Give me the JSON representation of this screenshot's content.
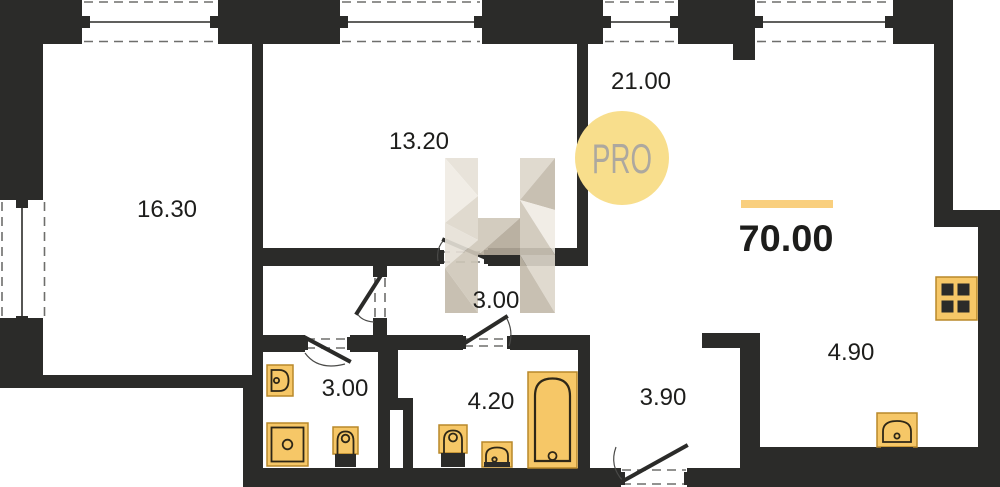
{
  "floorplan": {
    "badge_label": "PRO",
    "total_area": "70.00",
    "rooms": [
      {
        "key": "room-1630",
        "area": "16.30"
      },
      {
        "key": "room-1320",
        "area": "13.20"
      },
      {
        "key": "room-2100",
        "area": "21.00"
      },
      {
        "key": "hallway",
        "area": "3.00"
      },
      {
        "key": "bathroom-small",
        "area": "3.00"
      },
      {
        "key": "bathroom-large",
        "area": "4.20"
      },
      {
        "key": "entry-corridor",
        "area": "3.90"
      },
      {
        "key": "kitchen-niche",
        "area": "4.90"
      }
    ],
    "fixtures": [
      "wall-hung-sink",
      "shower-tray",
      "toilet",
      "toilet",
      "washbasin",
      "bathtub",
      "stove-4-burner",
      "kitchen-sink"
    ],
    "colors": {
      "wall": "#2B2B29",
      "dash": "#6E6E6C",
      "gold": "#F6C767",
      "goldStroke": "#B8882A",
      "detail": "#2E2717",
      "accent": "#F9CF7E",
      "badgeBg": "#F8DE8C",
      "badgeText": "#ADA89F",
      "ink": "#1D1D1B"
    }
  }
}
